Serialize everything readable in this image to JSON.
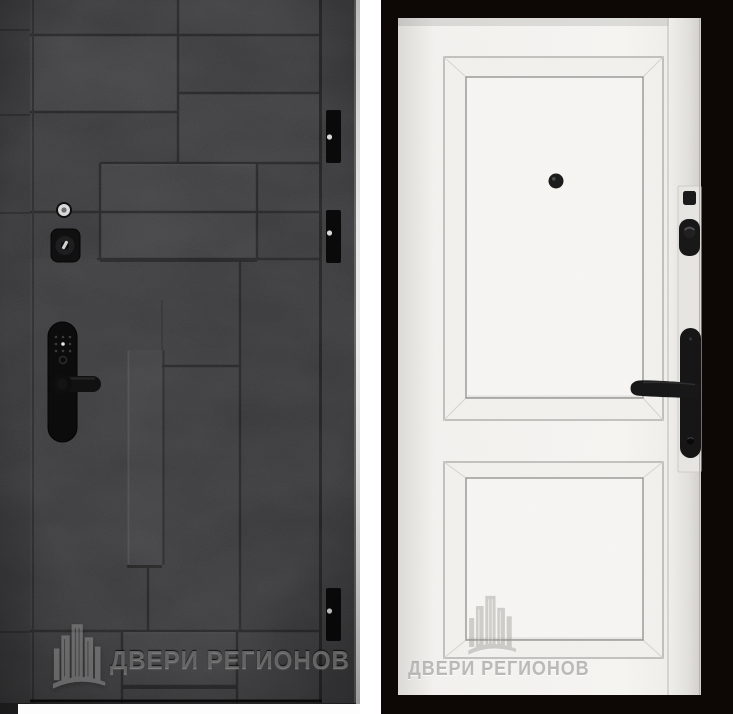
{
  "canvas": {
    "width": 733,
    "height": 714,
    "background": "#ffffff"
  },
  "brand": "ДВЕРИ РЕГИОНОВ",
  "left_panel": {
    "view": "door-exterior-front",
    "watermark": {
      "logo": "city-buildings-logo",
      "text": "ДВЕРИ РЕГИОНОВ"
    },
    "colors": {
      "surface": "#2f2f31",
      "groove": "#151516",
      "hardware": "#0d0d0e",
      "floor_strip": "#fdfdfd"
    },
    "hardware": [
      "peephole",
      "cylinder-lock",
      "smart-lock-keypad-handle"
    ],
    "hinge_count": 3
  },
  "right_panel": {
    "view": "door-interior-back",
    "watermark": {
      "logo": "city-buildings-logo",
      "text": "ДВЕРИ РЕГИОНОВ"
    },
    "colors": {
      "door": "#f5f4f1",
      "background": "#0d0806",
      "hardware": "#151516"
    },
    "hardware": [
      "peephole",
      "night-latch-square",
      "deadbolt-thumbturn",
      "lever-handle-with-keyhole"
    ],
    "panel_count": 2
  }
}
